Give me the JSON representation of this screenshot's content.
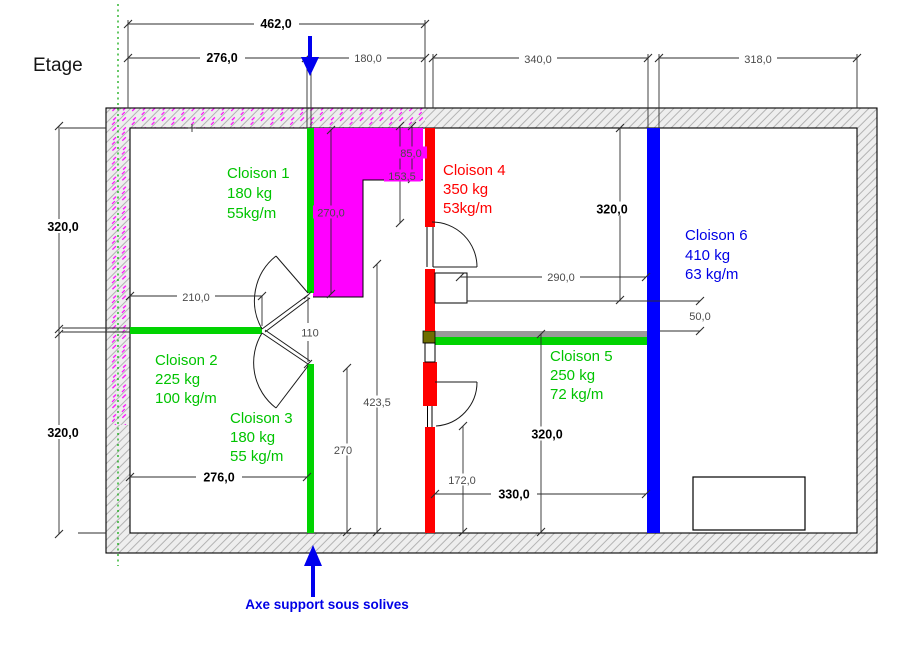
{
  "page": {
    "title": "Etage"
  },
  "axis": {
    "label": "Axe support sous solives"
  },
  "partitions": {
    "c1": {
      "name": "Cloison 1",
      "mass": "180 kg",
      "per_m": "55kg/m"
    },
    "c2": {
      "name": "Cloison 2",
      "mass": "225 kg",
      "per_m": "100 kg/m"
    },
    "c3": {
      "name": "Cloison 3",
      "mass": "180 kg",
      "per_m": "55 kg/m"
    },
    "c4": {
      "name": "Cloison 4",
      "mass": "350 kg",
      "per_m": "53kg/m"
    },
    "c5": {
      "name": "Cloison 5",
      "mass": "250 kg",
      "per_m": "72 kg/m"
    },
    "c6": {
      "name": "Cloison 6",
      "mass": "410 kg",
      "per_m": "63 kg/m"
    }
  },
  "dims": {
    "top_total": "462,0",
    "top_left": "276,0",
    "top_mid": "180,0",
    "top_right": "340,0",
    "top_far_right": "318,0",
    "left_upper": "320,0",
    "left_lower": "320,0",
    "room1_height": "270,0",
    "offset_85": "85,0",
    "offset_153": "153,5",
    "room1_width": "210,0",
    "door_gap": "110",
    "width_290": "290,0",
    "right_upper": "320,0",
    "offset_50": "50,0",
    "height_423": "423,5",
    "height_270": "270",
    "bottom_left_width": "276,0",
    "door_height_172": "172,0",
    "width_330": "330,0",
    "room5_height": "320,0"
  },
  "colors": {
    "wall_green": "#00d300",
    "text_green": "#00c400",
    "wall_red": "#ff0000",
    "text_red": "#ff0000",
    "wall_blue": "#0000ff",
    "text_blue": "#0000e6",
    "arrow_blue": "#0000ee",
    "magenta": "#ff00ff",
    "olive": "#6e6e00",
    "axis_green": "#00a400",
    "support_gray": "#9a9a9a"
  }
}
